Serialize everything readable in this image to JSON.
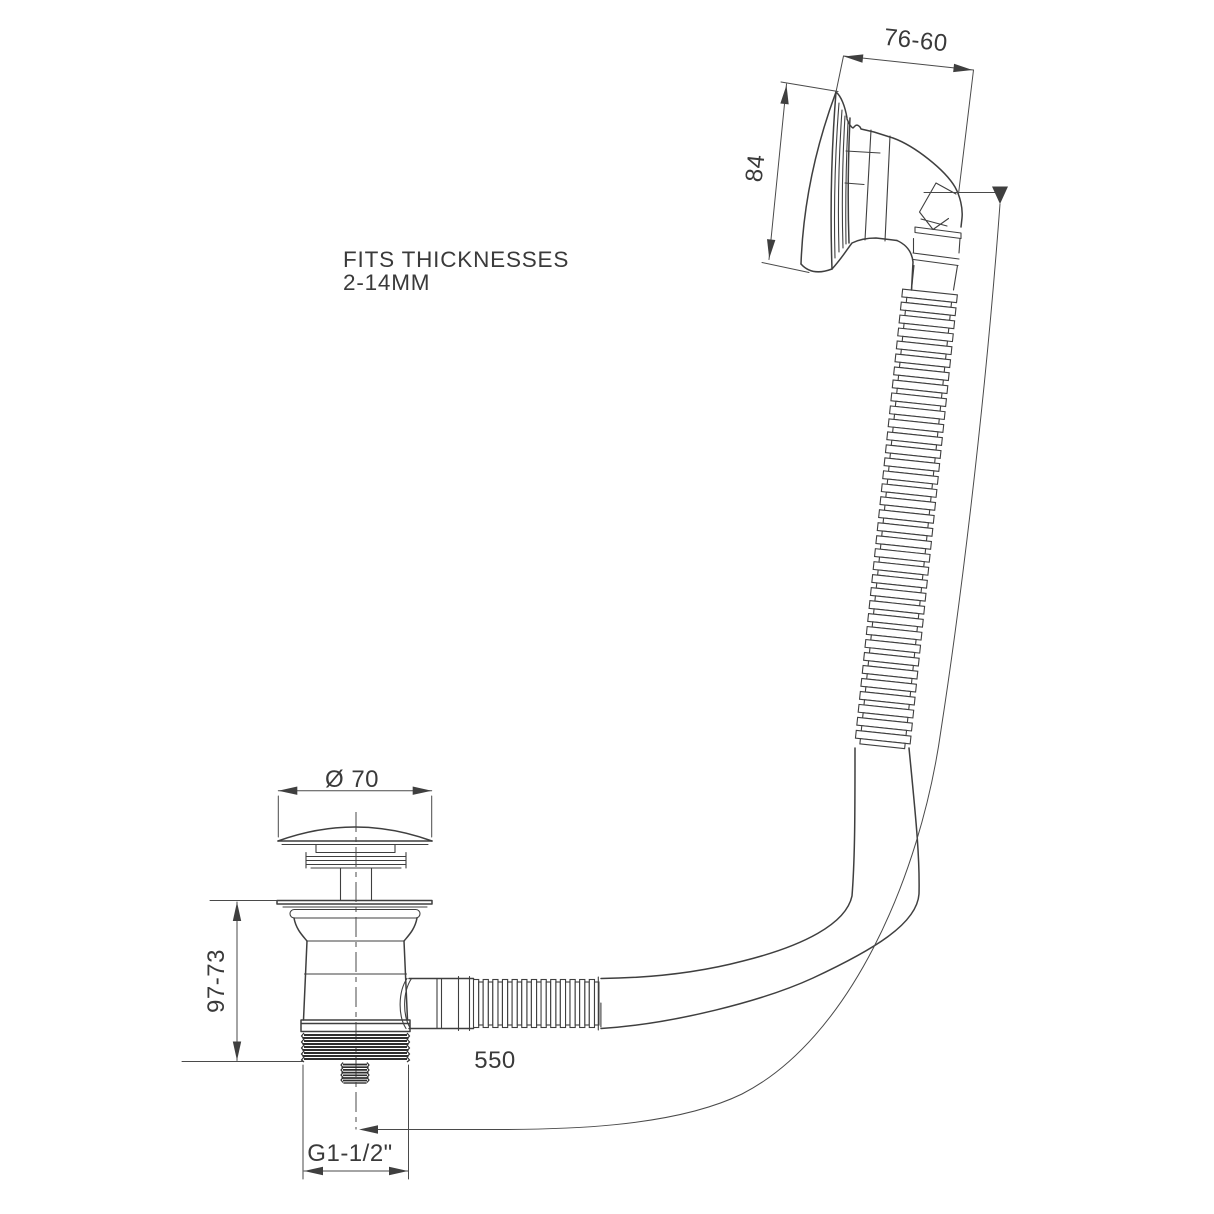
{
  "drawing": {
    "background": "#ffffff",
    "line_color": "#3f3f3f",
    "text_color": "#3a3a3a",
    "note": {
      "line1": "FITS THICKNESSES",
      "line2": "2-14MM"
    },
    "dimensions": {
      "overflow_depth": "76-60",
      "overflow_diameter": "84",
      "cap_diameter": "Ø 70",
      "body_height": "97-73",
      "hose_length": "550",
      "thread_size": "G1-1/2\""
    }
  }
}
